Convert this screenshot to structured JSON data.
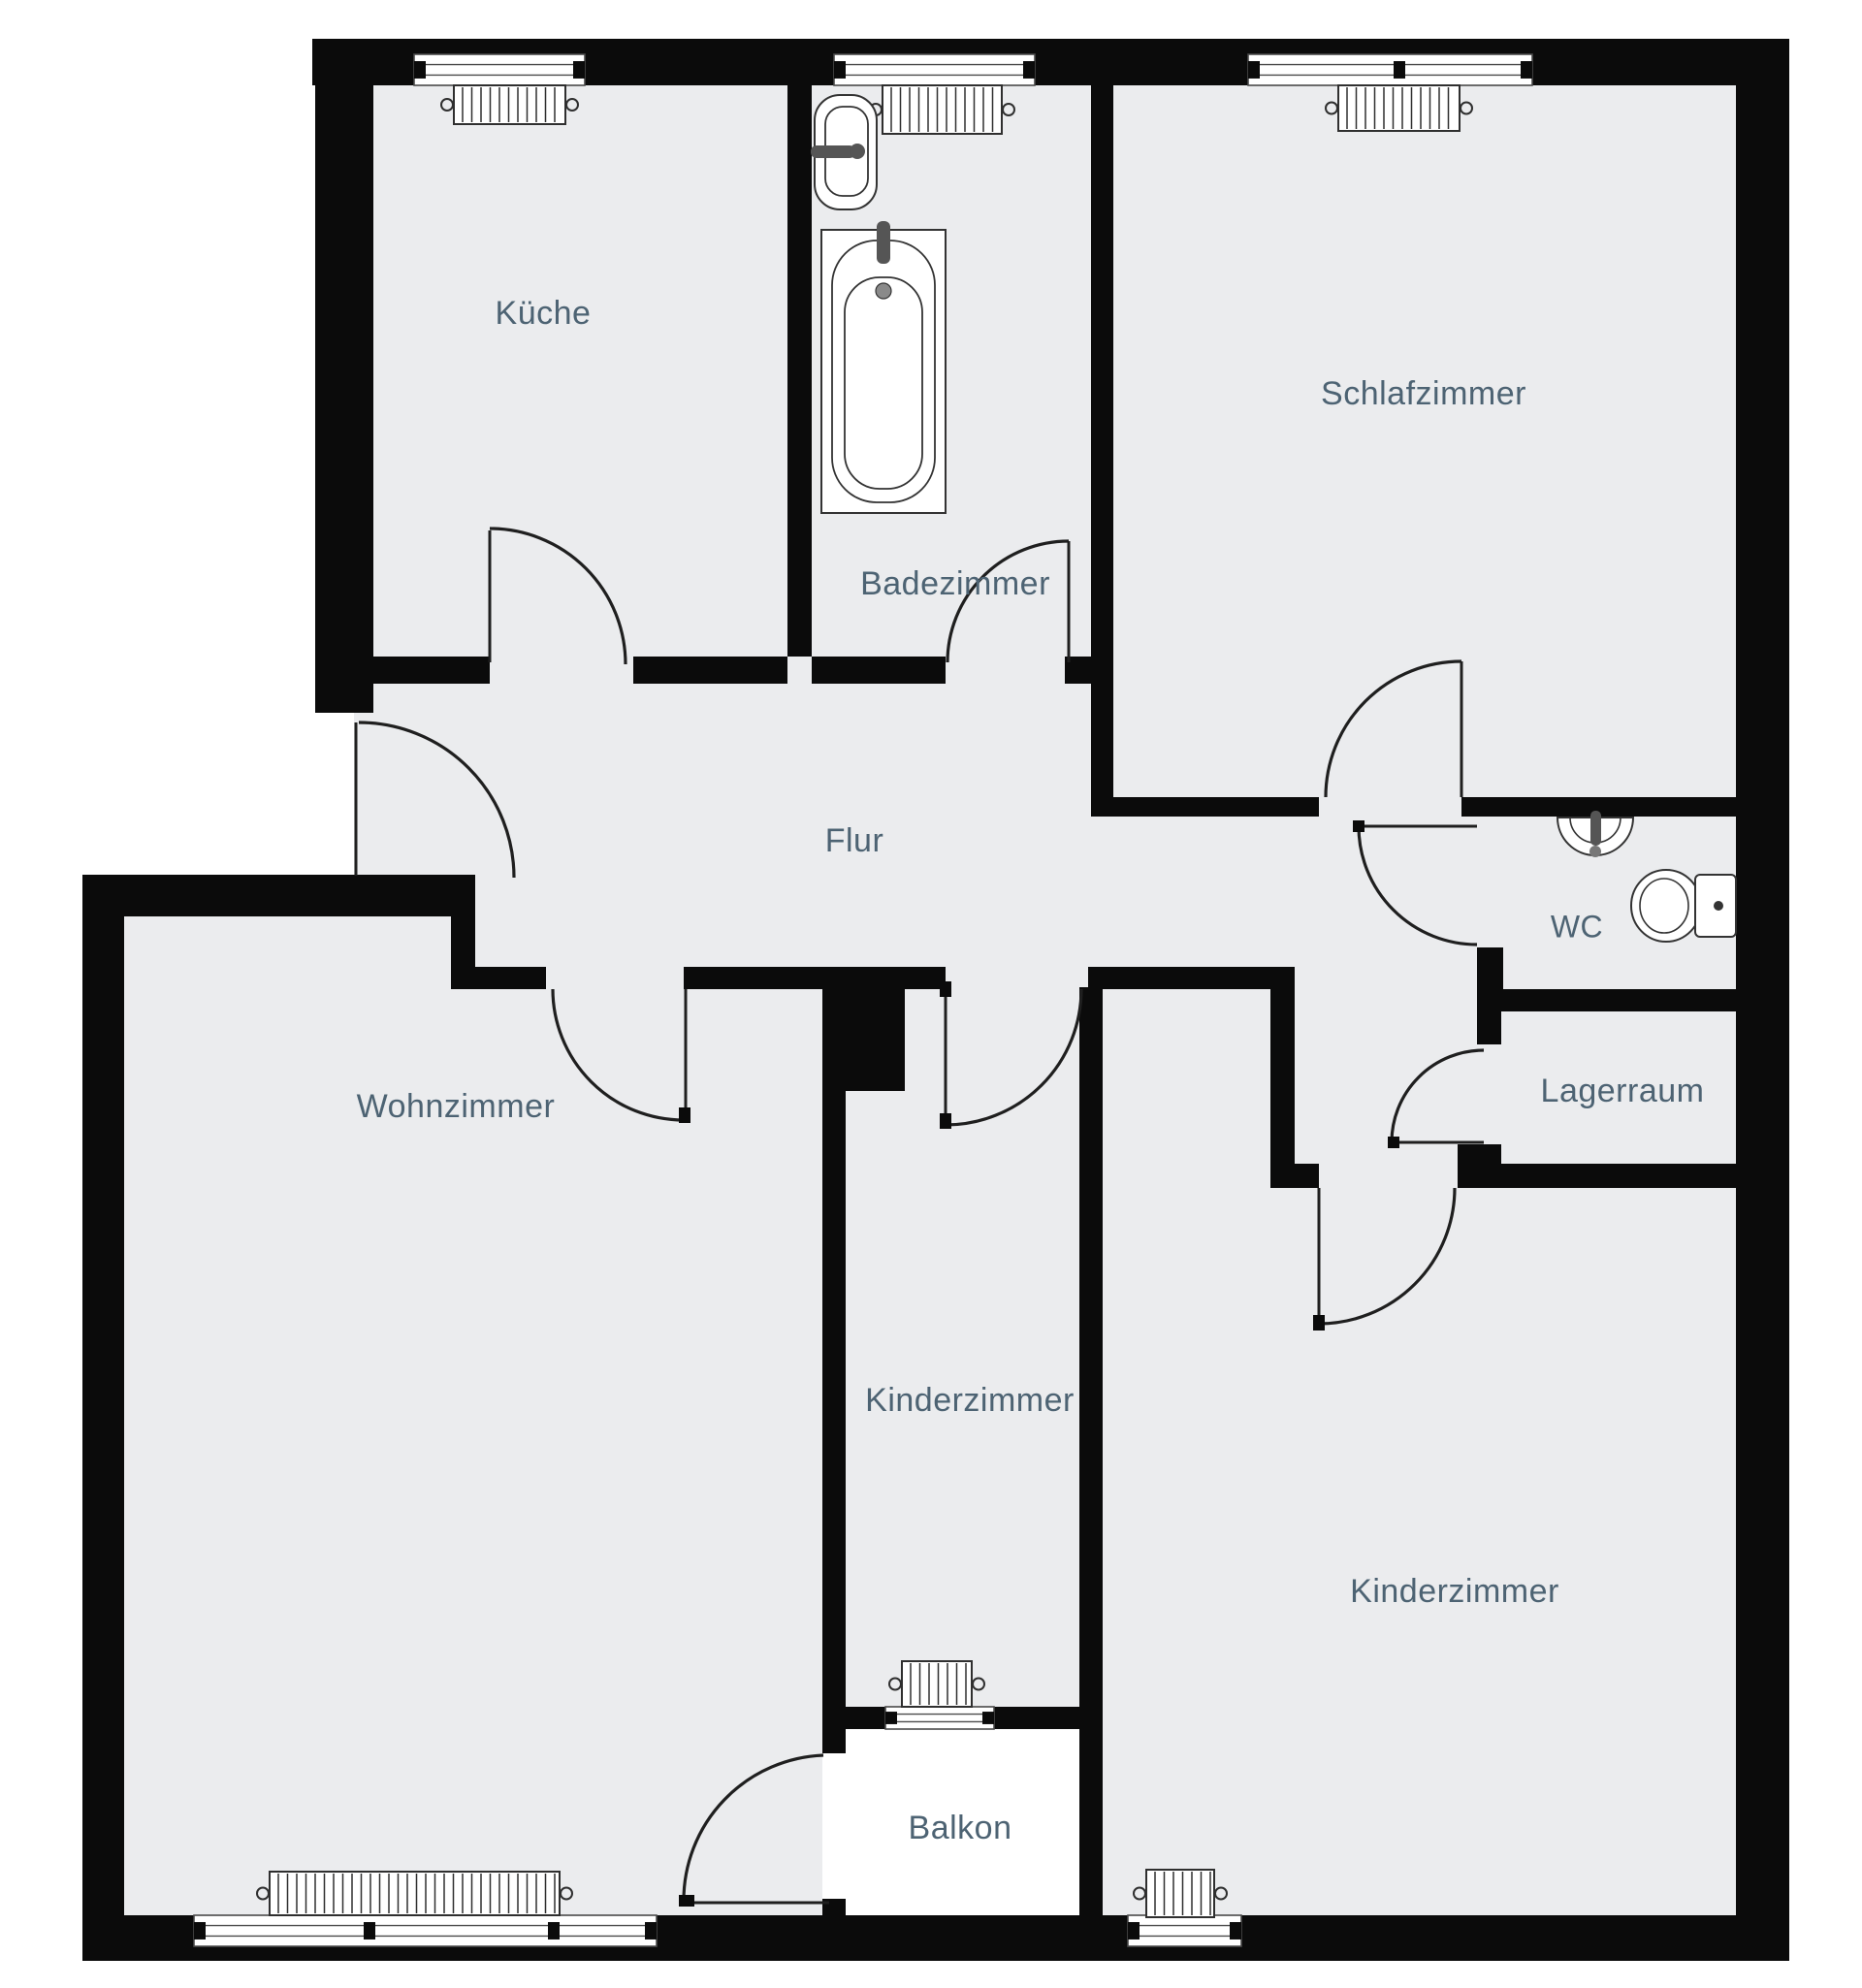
{
  "title": "Apartment floor plan",
  "colors": {
    "background": "#ffffff",
    "floor": "#ebecee",
    "balcony_floor": "#ffffff",
    "wall": "#0b0b0b",
    "door_line": "#1f1f1f",
    "window_frame": "#4a4a4a",
    "fixture_line": "#333333",
    "fixture_metal": "#555555",
    "label_text": "#4d6373"
  },
  "rooms": {
    "kueche": {
      "label": "Küche"
    },
    "badezimmer": {
      "label": "Badezimmer"
    },
    "schlafzimmer": {
      "label": "Schlafzimmer"
    },
    "flur": {
      "label": "Flur"
    },
    "wc": {
      "label": "WC"
    },
    "lagerraum": {
      "label": "Lagerraum"
    },
    "wohnzimmer": {
      "label": "Wohnzimmer"
    },
    "kinderzimmer_mitte": {
      "label": "Kinderzimmer"
    },
    "kinderzimmer_rechts": {
      "label": "Kinderzimmer"
    },
    "balkon": {
      "label": "Balkon"
    }
  }
}
